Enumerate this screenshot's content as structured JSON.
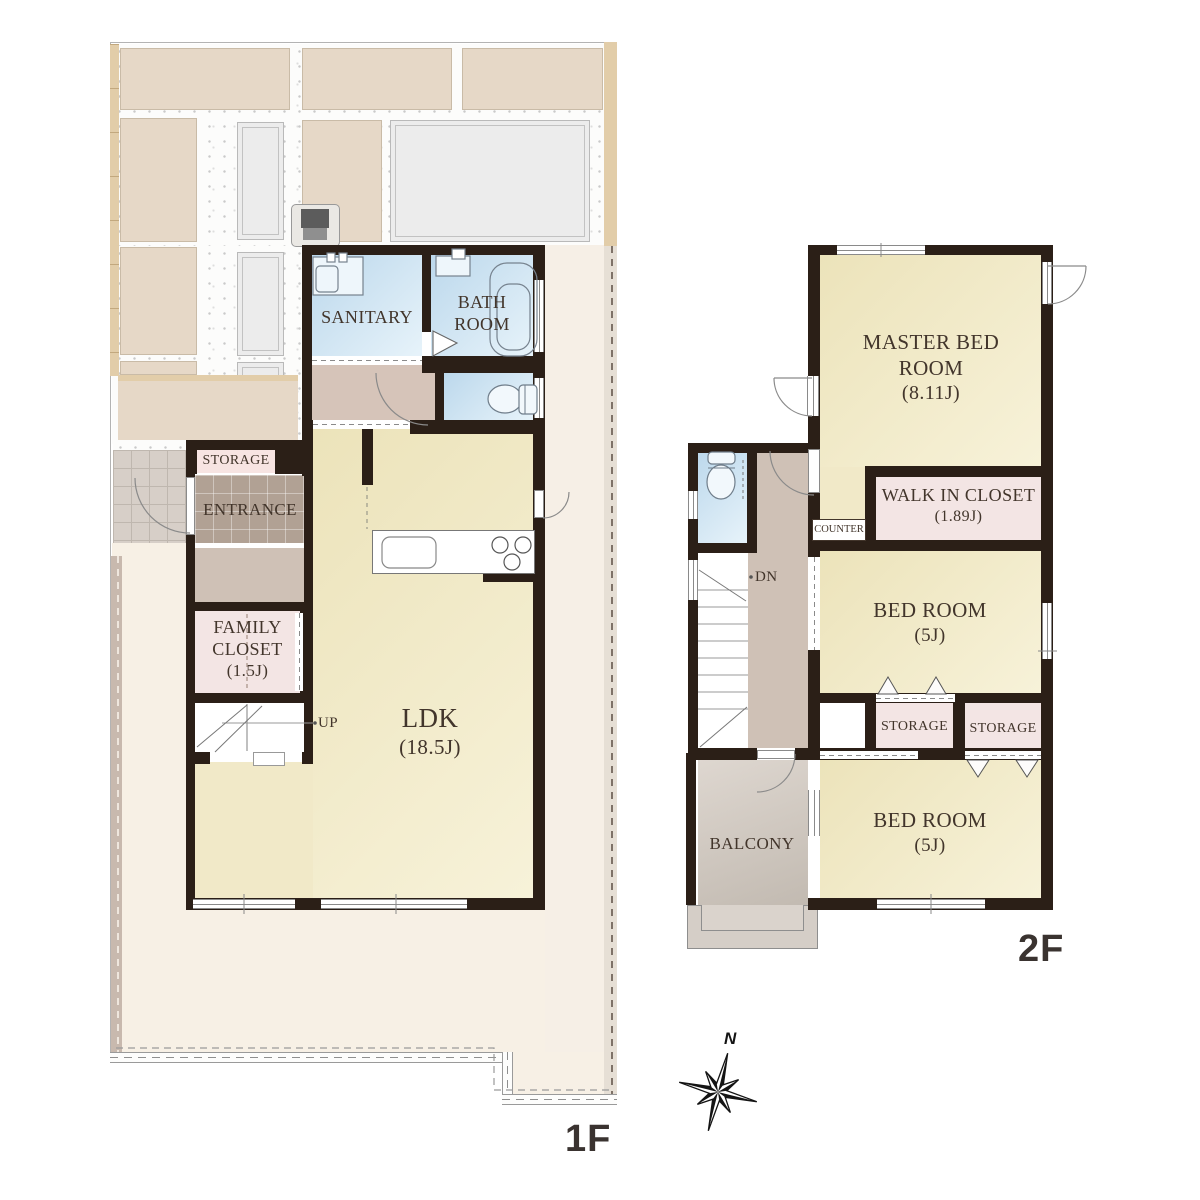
{
  "floor1": {
    "floor_label": "1F",
    "rooms": {
      "sanitary": {
        "name": "SANITARY"
      },
      "bathroom": {
        "name": "BATH ROOM"
      },
      "storage": {
        "name": "STORAGE"
      },
      "entrance": {
        "name": "ENTRANCE"
      },
      "family_closet": {
        "name": "FAMILY CLOSET",
        "area": "(1.5J)"
      },
      "ldk": {
        "name": "LDK",
        "area": "(18.5J)"
      }
    },
    "stair_label": "UP"
  },
  "floor2": {
    "floor_label": "2F",
    "rooms": {
      "master_bedroom": {
        "name": "MASTER BED ROOM",
        "area": "(8.11J)"
      },
      "walk_in_closet": {
        "name": "WALK IN CLOSET",
        "area": "(1.89J)"
      },
      "counter": {
        "name": "COUNTER"
      },
      "bedroom_east": {
        "name": "BED ROOM",
        "area": "(5J)"
      },
      "bedroom_south": {
        "name": "BED ROOM",
        "area": "(5J)"
      },
      "storage_left": {
        "name": "STORAGE"
      },
      "storage_right": {
        "name": "STORAGE"
      },
      "balcony": {
        "name": "BALCONY"
      }
    },
    "stair_label": "DN"
  },
  "compass": {
    "north_label": "N"
  },
  "colors": {
    "wall": "#2b1f17",
    "room_floor_cream": "#f1e9c8",
    "wet_room_blue": "#cfe3f1",
    "closet_pink": "#f3e5e4",
    "entrance_tile": "#b1a194",
    "hallway_greige": "#cfc1b6",
    "site_pad_beige": "#e6d8c7",
    "fence_tan": "#e2cda9",
    "balcony_gray": "#d5cdc5",
    "label_text": "#42352b",
    "floor_label_text": "#3a3330"
  }
}
